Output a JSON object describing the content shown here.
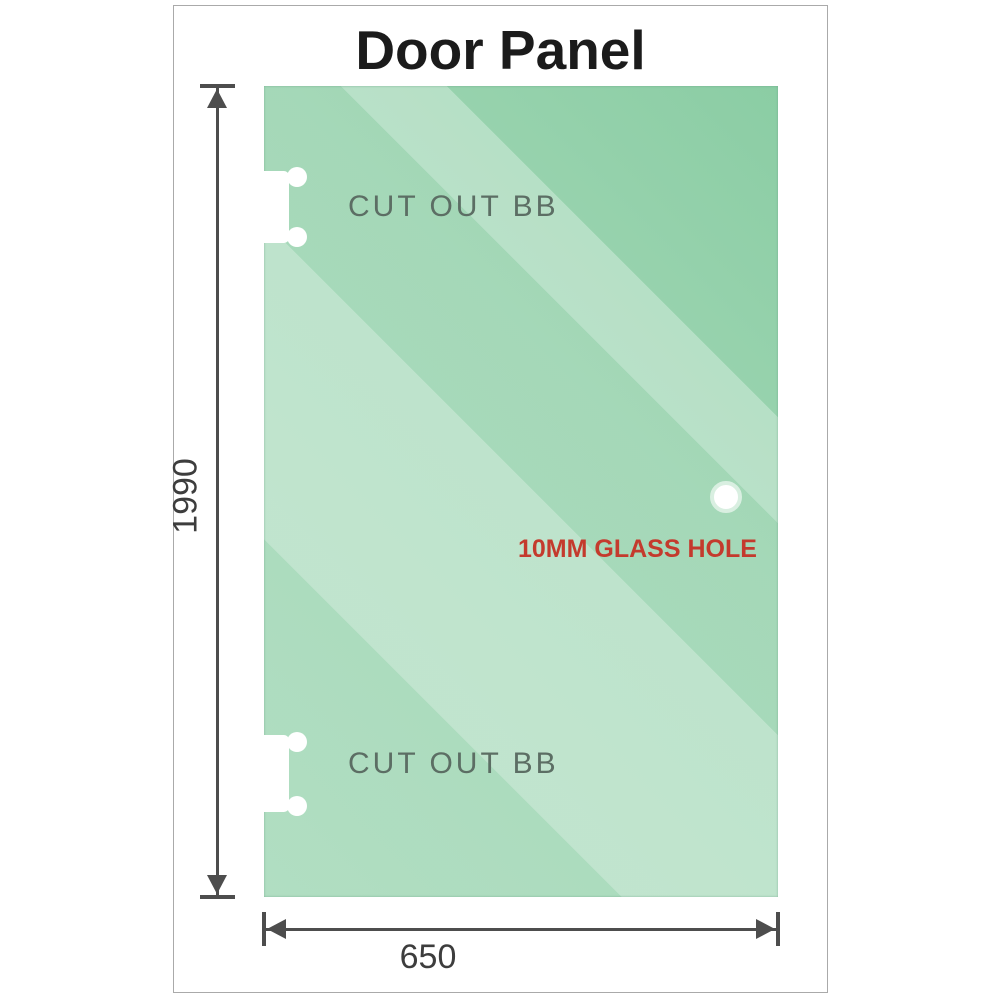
{
  "title": "Door Panel",
  "panel": {
    "cutouts": [
      {
        "label": "CUT OUT BB"
      },
      {
        "label": "CUT OUT BB"
      }
    ],
    "hole": {
      "label": "10MM GLASS HOLE"
    }
  },
  "dimensions": {
    "height": {
      "value": "1990"
    },
    "width": {
      "value": "650"
    }
  },
  "colors": {
    "glass_base": "#9dd5b2",
    "glass_dark": "#8bcda4",
    "glass_highlight": "#c2e7ce",
    "dimension_line": "#4d4d4d",
    "cutout_label": "#5c6e64",
    "hole_label": "#c43a2d",
    "title": "#1b1b1b",
    "frame_border": "#aaaaaa"
  }
}
